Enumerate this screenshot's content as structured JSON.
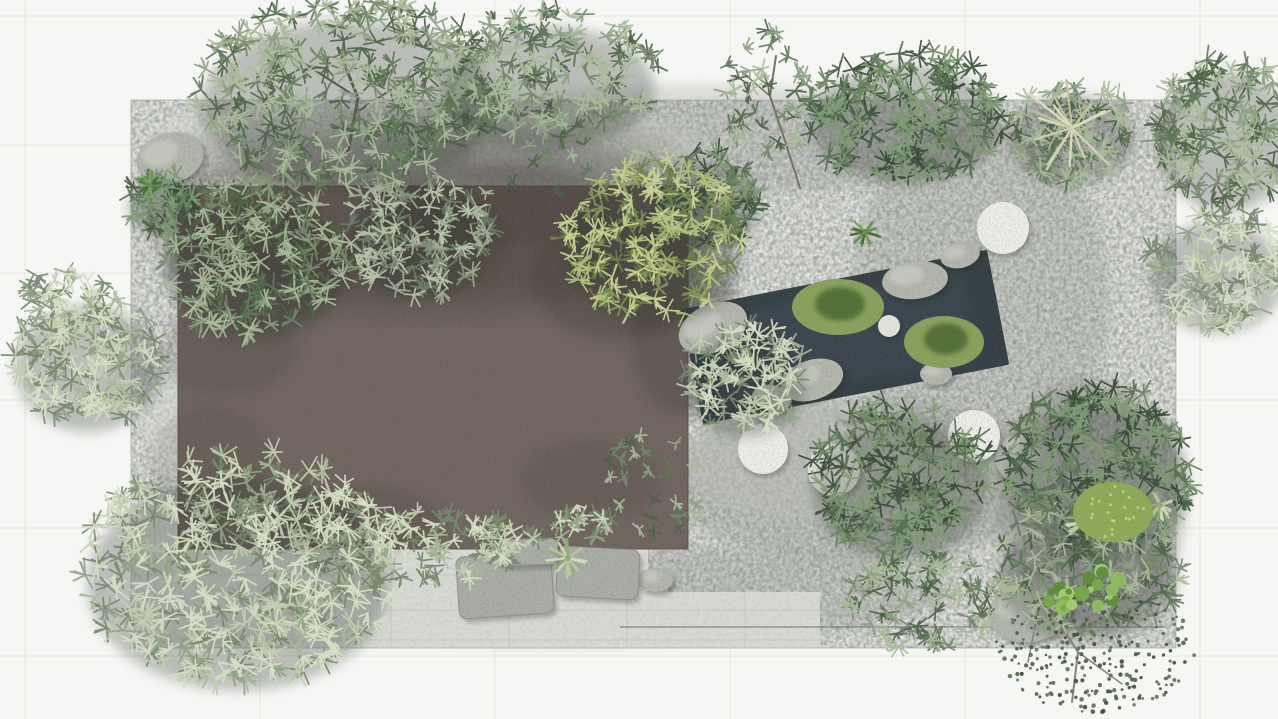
{
  "app": {
    "type": "aerial-garden-render",
    "description": "Top-down 3D rendering of a rectangular zen courtyard garden with gravel, flat roof, dark reflecting pond, boulders and round stone platforms"
  },
  "canvas": {
    "width": 1278,
    "height": 719
  },
  "background": {
    "fill": "#f6f6f4",
    "grid": {
      "vxs": [
        25,
        260,
        495,
        730,
        965,
        1200
      ],
      "hys": [
        16,
        145,
        273,
        400,
        528,
        656
      ],
      "stroke": "#d8dad4",
      "opacity": 0.55
    }
  },
  "courtyard": {
    "x": 131,
    "y": 100,
    "w": 1045,
    "h": 548,
    "fill": "#b2b6b0",
    "edge": "#969b95",
    "light_patches": [
      [
        520,
        150,
        190,
        45
      ],
      [
        250,
        140,
        95,
        35
      ],
      [
        800,
        460,
        115,
        60
      ],
      [
        300,
        420,
        160,
        90
      ],
      [
        560,
        620,
        180,
        30
      ]
    ],
    "dark_patches": [
      [
        700,
        140,
        300,
        55,
        0.25
      ],
      [
        860,
        480,
        200,
        80,
        0.3
      ],
      [
        980,
        300,
        130,
        180,
        0.25
      ],
      [
        700,
        592,
        250,
        45,
        0.28
      ],
      [
        1090,
        505,
        95,
        125,
        0.45
      ],
      [
        420,
        150,
        260,
        40,
        0.18
      ]
    ],
    "pale_fill": "#d8dad5",
    "pale_zones": [
      [
        131,
        500,
        517,
        148
      ],
      [
        380,
        592,
        440,
        56
      ]
    ],
    "pale_joints": [
      [
        155,
        500,
        155,
        648
      ],
      [
        273,
        500,
        273,
        648
      ],
      [
        391,
        500,
        391,
        648
      ],
      [
        509,
        500,
        509,
        648
      ],
      [
        627,
        592,
        627,
        648
      ],
      [
        745,
        592,
        745,
        648
      ],
      [
        131,
        512,
        648,
        512
      ],
      [
        131,
        575,
        648,
        575
      ],
      [
        131,
        640,
        820,
        640
      ],
      [
        380,
        610,
        820,
        610
      ]
    ],
    "bottom_curb": [
      620,
      627,
      1166,
      627
    ]
  },
  "roof": {
    "x": 178,
    "y": 186,
    "w": 510,
    "h": 363,
    "fill": "#6c615b",
    "edge": "#554c46",
    "top_shade": "#3e3630",
    "shadow_blobs": [
      [
        260,
        265,
        95,
        60,
        0.32
      ],
      [
        430,
        245,
        80,
        50,
        0.28
      ],
      [
        620,
        275,
        90,
        65,
        0.32
      ],
      [
        685,
        330,
        55,
        85,
        0.28
      ],
      [
        500,
        205,
        120,
        40,
        0.3
      ],
      [
        225,
        350,
        70,
        45,
        0.18
      ],
      [
        350,
        520,
        95,
        35,
        0.2
      ],
      [
        590,
        480,
        70,
        40,
        0.16
      ],
      [
        210,
        465,
        60,
        60,
        0.14
      ]
    ]
  },
  "pond": {
    "cx": 845,
    "cy": 337,
    "w": 312,
    "h": 117,
    "rotation": -11,
    "fill": "#333d45",
    "sheen": "#4d5c66",
    "boulders": [
      [
        713,
        328,
        36,
        24,
        -25
      ],
      [
        772,
        398,
        20,
        13,
        12
      ],
      [
        812,
        380,
        32,
        20,
        -18
      ],
      [
        915,
        280,
        33,
        19,
        -6
      ],
      [
        936,
        374,
        16,
        11,
        0
      ],
      [
        848,
        411,
        14,
        10,
        6
      ],
      [
        960,
        255,
        20,
        13,
        -12
      ]
    ],
    "moss_fill": "#8aa455",
    "moss_dark": "#4d6836",
    "moss": [
      [
        838,
        307,
        46,
        28
      ],
      [
        944,
        342,
        40,
        26
      ]
    ],
    "stepping_stone": [
      889,
      326,
      11
    ]
  },
  "discs": {
    "fill": "#e9e9e3",
    "items": [
      [
        1003,
        228,
        26
      ],
      [
        763,
        449,
        25
      ],
      [
        834,
        470,
        26
      ],
      [
        974,
        436,
        26
      ]
    ]
  },
  "rocks": {
    "fill": "#b7bab1",
    "items": [
      [
        170,
        158,
        34,
        25,
        -15
      ],
      [
        1028,
        462,
        34,
        26,
        20
      ],
      [
        1030,
        612,
        42,
        30,
        -10
      ],
      [
        655,
        580,
        18,
        12,
        0
      ]
    ]
  },
  "slabs": {
    "fill": "#aeb1a9",
    "edge": "#8f9289",
    "items": [
      [
        505,
        585,
        95,
        62,
        -4
      ],
      [
        598,
        573,
        82,
        50,
        3
      ],
      [
        527,
        552,
        62,
        26,
        -2
      ]
    ]
  },
  "plants": {
    "shadow": "#333a33",
    "palettes": {
      "pale": [
        "#77896f",
        "#8fa287",
        "#a9b99b",
        "#c3ceb0",
        "#d7dfc6"
      ],
      "mid": [
        "#4e6449",
        "#5f7759",
        "#74896c",
        "#8da183",
        "#a9bb9a"
      ],
      "dark": [
        "#384d38",
        "#465d45",
        "#567052",
        "#688260",
        "#7f9a74"
      ],
      "yellow": [
        "#6f814c",
        "#84965c",
        "#9cab6c",
        "#b3c07e",
        "#c9d392"
      ],
      "gray": [
        "#6e7f6a",
        "#86957e",
        "#9fae93",
        "#b9c5aa"
      ],
      "tiny": [
        "#3f4f3d",
        "#4f6049",
        "#5f7057"
      ]
    },
    "clusters": [
      {
        "id": "sprigs-top-band",
        "x": 520,
        "y": 148,
        "rx": 170,
        "ry": 46,
        "pal": "mid",
        "count": 30,
        "len": 7,
        "shadow": 0
      },
      {
        "id": "sprigs-center",
        "x": 660,
        "y": 482,
        "rx": 55,
        "ry": 52,
        "pal": "mid",
        "count": 26,
        "len": 7,
        "shadow": 0
      },
      {
        "id": "bamboo-roof-topleft",
        "x": 255,
        "y": 258,
        "rx": 92,
        "ry": 80,
        "pal": "mid",
        "count": 175,
        "len": 12
      },
      {
        "id": "shrub-roof-upper",
        "x": 418,
        "y": 232,
        "rx": 72,
        "ry": 64,
        "pal": "gray",
        "count": 105,
        "len": 11
      },
      {
        "id": "fern-rock-topleft",
        "x": 162,
        "y": 202,
        "rx": 36,
        "ry": 30,
        "pal": "dark",
        "count": 50,
        "len": 10
      },
      {
        "id": "bamboo-left-edge",
        "x": 88,
        "y": 358,
        "rx": 76,
        "ry": 70,
        "pal": "pale",
        "count": 120,
        "len": 12
      },
      {
        "id": "leaf-spray-left",
        "x": 68,
        "y": 300,
        "rx": 48,
        "ry": 36,
        "pal": "pale",
        "count": 36,
        "len": 10,
        "shadow": 0
      },
      {
        "id": "tree-canopy-topleft",
        "x": 348,
        "y": 92,
        "rx": 155,
        "ry": 95,
        "pal": "mid",
        "count": 280,
        "len": 12
      },
      {
        "id": "tree-canopy-top2",
        "x": 548,
        "y": 78,
        "rx": 112,
        "ry": 68,
        "pal": "mid",
        "count": 150,
        "len": 11
      },
      {
        "id": "shrub-roof-gap",
        "x": 706,
        "y": 198,
        "rx": 56,
        "ry": 48,
        "pal": "dark",
        "count": 70,
        "len": 11
      },
      {
        "id": "tree-canopy-yellow",
        "x": 655,
        "y": 240,
        "rx": 92,
        "ry": 82,
        "pal": "yellow",
        "count": 165,
        "len": 11
      },
      {
        "id": "sapling-sparse",
        "x": 772,
        "y": 90,
        "rx": 56,
        "ry": 62,
        "pal": "mid",
        "count": 40,
        "len": 9,
        "shadow": 0
      },
      {
        "id": "shrub-top-right",
        "x": 905,
        "y": 114,
        "rx": 100,
        "ry": 66,
        "pal": "dark",
        "count": 155,
        "len": 12
      },
      {
        "id": "grass-clump-base",
        "x": 1072,
        "y": 132,
        "rx": 66,
        "ry": 50,
        "pal": "mid",
        "count": 75,
        "len": 11
      },
      {
        "id": "shrub-right-top",
        "x": 1226,
        "y": 130,
        "rx": 72,
        "ry": 78,
        "pal": "mid",
        "count": 120,
        "len": 12
      },
      {
        "id": "shrub-right-mid",
        "x": 1218,
        "y": 268,
        "rx": 70,
        "ry": 62,
        "pal": "pale",
        "count": 100,
        "len": 12
      },
      {
        "id": "bush-pond-left",
        "x": 745,
        "y": 378,
        "rx": 62,
        "ry": 56,
        "pal": "pale",
        "count": 90,
        "len": 11
      },
      {
        "id": "tuft-roof-1",
        "x": 265,
        "y": 515,
        "rx": 30,
        "ry": 22,
        "pal": "pale",
        "count": 24,
        "len": 9,
        "shadow": 0
      },
      {
        "id": "tuft-roof-2",
        "x": 345,
        "y": 546,
        "rx": 32,
        "ry": 24,
        "pal": "pale",
        "count": 24,
        "len": 9,
        "shadow": 0
      },
      {
        "id": "tuft-roof-3",
        "x": 505,
        "y": 540,
        "rx": 35,
        "ry": 25,
        "pal": "pale",
        "count": 26,
        "len": 9,
        "shadow": 0
      },
      {
        "id": "tuft-roof-4",
        "x": 585,
        "y": 524,
        "rx": 30,
        "ry": 22,
        "pal": "pale",
        "count": 22,
        "len": 9,
        "shadow": 0
      },
      {
        "id": "shrub-bottom-strip",
        "x": 400,
        "y": 548,
        "rx": 118,
        "ry": 44,
        "pal": "pale",
        "count": 85,
        "len": 10,
        "shadow": 0
      },
      {
        "id": "bamboo-bottom-left",
        "x": 238,
        "y": 566,
        "rx": 158,
        "ry": 118,
        "pal": "pale",
        "count": 350,
        "len": 13
      },
      {
        "id": "bamboo-bottom-mid",
        "x": 900,
        "y": 478,
        "rx": 92,
        "ry": 78,
        "pal": "dark",
        "count": 155,
        "len": 12
      },
      {
        "id": "shrub-bottom-band",
        "x": 925,
        "y": 602,
        "rx": 85,
        "ry": 48,
        "pal": "mid",
        "count": 80,
        "len": 10,
        "shadow": 0
      },
      {
        "id": "bed-bottom-right",
        "x": 1098,
        "y": 468,
        "rx": 95,
        "ry": 86,
        "pal": "dark",
        "count": 170,
        "len": 12
      },
      {
        "id": "bed-corner",
        "x": 1088,
        "y": 568,
        "rx": 95,
        "ry": 68,
        "pal": "mid",
        "count": 125,
        "len": 11
      },
      {
        "id": "creeper-bottom-right",
        "x": 1095,
        "y": 650,
        "rx": 100,
        "ry": 62,
        "pal": "tiny",
        "count": 280,
        "len": 4,
        "style": "dots",
        "shadow": 0
      }
    ],
    "branches": [
      {
        "pts": [
          [
            348,
            152
          ],
          [
            358,
            98
          ],
          [
            338,
            48
          ]
        ],
        "w": 3,
        "c": "#6f6757"
      },
      {
        "pts": [
          [
            358,
            98
          ],
          [
            302,
            62
          ]
        ],
        "w": 2,
        "c": "#6f6757"
      },
      {
        "pts": [
          [
            360,
            110
          ],
          [
            424,
            68
          ]
        ],
        "w": 2,
        "c": "#6f6757"
      },
      {
        "pts": [
          [
            800,
            188
          ],
          [
            784,
            138
          ],
          [
            770,
            96
          ],
          [
            776,
            56
          ]
        ],
        "w": 2,
        "c": "#7a7263"
      },
      {
        "pts": [
          [
            770,
            96
          ],
          [
            742,
            72
          ]
        ],
        "w": 1.5,
        "c": "#7a7263"
      },
      {
        "pts": [
          [
            1052,
            612
          ],
          [
            1078,
            652
          ],
          [
            1072,
            702
          ]
        ],
        "w": 2,
        "c": "#8a8478"
      },
      {
        "pts": [
          [
            1078,
            652
          ],
          [
            1122,
            684
          ]
        ],
        "w": 1.5,
        "c": "#8a8478"
      },
      {
        "pts": [
          [
            1040,
            602
          ],
          [
            1028,
            662
          ]
        ],
        "w": 1.5,
        "c": "#8a8478"
      }
    ],
    "plumes": {
      "x": 1072,
      "y": 128,
      "count": 17,
      "min": 26,
      "max": 56,
      "colors": [
        "#e2e0c2",
        "#d2d2ae",
        "#c3c6a0"
      ],
      "width": 2.2
    },
    "agaves": {
      "pale_colors": [
        "#b9c9a2",
        "#93ab7d",
        "#d2dcb8"
      ],
      "dark_colors": [
        "#4e6a40",
        "#639052",
        "#77a862"
      ],
      "items": [
        [
          568,
          558,
          22,
          "pale"
        ],
        [
          1085,
          522,
          20,
          "pale"
        ],
        [
          1160,
          505,
          16,
          "pale"
        ],
        [
          865,
          232,
          16,
          "dark"
        ],
        [
          150,
          185,
          14,
          "dark"
        ]
      ]
    },
    "moss_mounds": {
      "fill": "#8fae53",
      "dot": "#c9d87e",
      "items": [
        [
          1113,
          512,
          40,
          30
        ]
      ]
    },
    "leaf_plants": {
      "colors": [
        "#5f8c3a",
        "#79a94c",
        "#8fbb5e",
        "#a5cc70"
      ],
      "items": [
        [
          1098,
          588,
          34
        ],
        [
          1062,
          600,
          20
        ]
      ]
    }
  }
}
